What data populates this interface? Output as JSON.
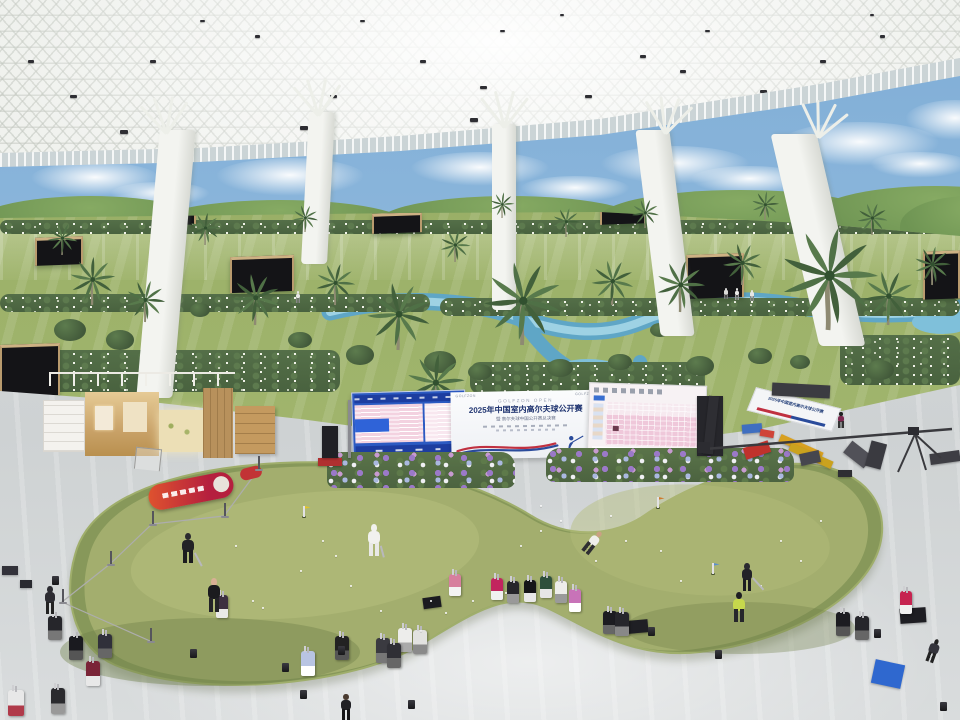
{
  "banner": {
    "top_label": "GOLFZON OPEN",
    "title": "2025年中国室内高尔夫球公开赛",
    "subtitle": "暨 高尔夫球中国公开赛总决赛",
    "left_logo": "GOLFZON",
    "right_logo": "GOLFZON"
  },
  "colors": {
    "ceiling": "#f4f5f2",
    "sky_mural": "#8fb9dd",
    "turf": "#9db26a",
    "floor": "#d3d7d8",
    "putting_green": "#8a9b5c",
    "putting_green_light": "#a2ad6d",
    "water": "#6fb3cf",
    "banner_navy": "#1f3470",
    "wave_red": "#c03040",
    "wave_blue": "#2a4b9b",
    "led_blue": "#2c5ac2",
    "led_pink": "#efc8da",
    "flower_purple": "#9b79c8",
    "flower_blue": "#aab8e0",
    "flower_white": "#f0f0f4",
    "booth_wood": "#c9a268",
    "red_bag": "#b51f3e"
  },
  "ceiling_lamps": [
    [
      70,
      95
    ],
    [
      150,
      60
    ],
    [
      255,
      35
    ],
    [
      330,
      95
    ],
    [
      420,
      60
    ],
    [
      500,
      30
    ],
    [
      585,
      95
    ],
    [
      640,
      55
    ],
    [
      705,
      30
    ],
    [
      760,
      90
    ],
    [
      820,
      60
    ],
    [
      880,
      35
    ],
    [
      915,
      88
    ],
    [
      120,
      130
    ],
    [
      300,
      126
    ],
    [
      470,
      118
    ],
    [
      640,
      118
    ],
    [
      790,
      108
    ],
    [
      900,
      100
    ],
    [
      200,
      20
    ],
    [
      560,
      14
    ],
    [
      680,
      70
    ],
    [
      28,
      60
    ],
    [
      480,
      86
    ],
    [
      725,
      112
    ],
    [
      870,
      14
    ],
    [
      360,
      20
    ]
  ],
  "clouds": [
    [
      30,
      162,
      130,
      34
    ],
    [
      215,
      158,
      150,
      38
    ],
    [
      410,
      152,
      140,
      34
    ],
    [
      600,
      146,
      150,
      38
    ],
    [
      780,
      122,
      160,
      44
    ],
    [
      905,
      100,
      100,
      40
    ],
    [
      110,
      182,
      100,
      24
    ],
    [
      520,
      176,
      110,
      26
    ],
    [
      690,
      166,
      120,
      28
    ],
    [
      870,
      152,
      100,
      26
    ]
  ],
  "hills": [
    [
      -30,
      196,
      240,
      60
    ],
    [
      150,
      200,
      260,
      52
    ],
    [
      380,
      196,
      260,
      50
    ],
    [
      600,
      190,
      280,
      56
    ],
    [
      810,
      186,
      250,
      66
    ],
    [
      900,
      196,
      140,
      60
    ]
  ],
  "columns": [
    {
      "x": 148,
      "y": 130,
      "w": 36,
      "h": 268,
      "skew": -5
    },
    {
      "x": 305,
      "y": 112,
      "w": 26,
      "h": 152,
      "skew": -3
    },
    {
      "x": 492,
      "y": 124,
      "w": 24,
      "h": 186,
      "skew": 0
    },
    {
      "x": 648,
      "y": 130,
      "w": 34,
      "h": 206,
      "skew": 7
    },
    {
      "x": 795,
      "y": 134,
      "w": 46,
      "h": 212,
      "skew": 13
    }
  ],
  "palms": [
    [
      92,
      305,
      0.75
    ],
    [
      145,
      322,
      0.65
    ],
    [
      255,
      325,
      0.8
    ],
    [
      335,
      305,
      0.65
    ],
    [
      398,
      350,
      1.05
    ],
    [
      455,
      262,
      0.5
    ],
    [
      522,
      345,
      1.3
    ],
    [
      566,
      237,
      0.45
    ],
    [
      612,
      305,
      0.7
    ],
    [
      680,
      312,
      0.8
    ],
    [
      742,
      285,
      0.65
    ],
    [
      828,
      330,
      1.6
    ],
    [
      888,
      325,
      0.85
    ],
    [
      932,
      285,
      0.6
    ],
    [
      62,
      255,
      0.5
    ],
    [
      205,
      245,
      0.5
    ],
    [
      305,
      232,
      0.42
    ],
    [
      502,
      218,
      0.4
    ],
    [
      645,
      228,
      0.45
    ],
    [
      765,
      220,
      0.45
    ],
    [
      872,
      235,
      0.5
    ],
    [
      435,
      415,
      0.95
    ],
    [
      572,
      432,
      0.7
    ]
  ],
  "pavilions": [
    [
      35,
      237,
      48,
      28
    ],
    [
      160,
      205,
      36,
      20
    ],
    [
      230,
      256,
      64,
      36
    ],
    [
      372,
      213,
      50,
      20
    ],
    [
      600,
      202,
      46,
      22
    ],
    [
      686,
      254,
      58,
      44
    ],
    [
      923,
      251,
      37,
      48
    ],
    [
      0,
      344,
      60,
      52
    ],
    [
      806,
      208,
      38,
      18
    ]
  ],
  "hedges": [
    [
      0,
      220,
      960,
      14
    ],
    [
      0,
      294,
      430,
      18
    ],
    [
      440,
      298,
      520,
      18
    ],
    [
      0,
      350,
      340,
      42
    ],
    [
      840,
      335,
      120,
      50
    ],
    [
      470,
      362,
      235,
      32
    ]
  ],
  "bushes": [
    [
      70,
      330,
      16
    ],
    [
      120,
      340,
      14
    ],
    [
      300,
      340,
      12
    ],
    [
      360,
      355,
      14
    ],
    [
      440,
      362,
      16
    ],
    [
      480,
      372,
      12
    ],
    [
      560,
      368,
      13
    ],
    [
      620,
      362,
      12
    ],
    [
      700,
      366,
      14
    ],
    [
      760,
      356,
      12
    ],
    [
      800,
      362,
      10
    ],
    [
      880,
      370,
      14
    ],
    [
      200,
      310,
      10
    ],
    [
      660,
      330,
      10
    ]
  ],
  "flower_beds": [
    [
      327,
      452,
      188,
      36
    ],
    [
      546,
      448,
      248,
      34
    ]
  ],
  "people": [
    [
      188,
      563,
      30,
      "#222226",
      "#1c1c1f",
      "#2a2a2e",
      0
    ],
    [
      214,
      612,
      34,
      "#1b1b1e",
      "#232327",
      "#d8b094",
      0
    ],
    [
      374,
      556,
      32,
      "#f1f1ee",
      "#e9e9e6",
      "#f1f1ee",
      0
    ],
    [
      586,
      553,
      26,
      "#efefeb",
      "#2e2e32",
      "#caa183",
      38
    ],
    [
      747,
      591,
      28,
      "#222228",
      "#1d1d22",
      "#2a2a30",
      0
    ],
    [
      739,
      622,
      30,
      "#c6d84c",
      "#26262b",
      "#1d1d22",
      0
    ],
    [
      50,
      614,
      28,
      "#2c2c32",
      "#222222",
      "#2c2c32",
      0
    ],
    [
      346,
      720,
      26,
      "#202024",
      "#151517",
      "#4a3b30",
      0
    ],
    [
      930,
      662,
      24,
      "#34343c",
      "#222222",
      "#222222",
      20
    ],
    [
      841,
      428,
      16,
      "#7e2950",
      "#333333",
      "#222222",
      0
    ],
    [
      298,
      303,
      12,
      "#e8e8e6",
      "#888888",
      "#e8e8e6",
      0
    ],
    [
      737,
      300,
      12,
      "#eaeae8",
      "#999999",
      "#eaeae8",
      0
    ],
    [
      752,
      301,
      11,
      "#e6e6e4",
      "#888888",
      "#e6e6e4",
      0
    ],
    [
      726,
      299,
      11,
      "#dadad8",
      "#777777",
      "#dadad8",
      0
    ]
  ],
  "putters": [
    [
      195,
      552,
      15,
      62
    ],
    [
      753,
      577,
      16,
      48
    ],
    [
      381,
      545,
      12,
      75
    ]
  ],
  "golf_bags": [
    [
      455,
      596,
      "#d77f9e",
      "#f3f3f3"
    ],
    [
      497,
      600,
      "#c2245e",
      "#f0f0f0"
    ],
    [
      513,
      603,
      "#26262b",
      "#999999"
    ],
    [
      530,
      602,
      "#151518",
      "#e8e8e8"
    ],
    [
      546,
      598,
      "#2e4f3c",
      "#e6e6e6"
    ],
    [
      561,
      603,
      "#ededea",
      "#9a9a9a"
    ],
    [
      575,
      612,
      "#c873b8",
      "#ffffff"
    ],
    [
      610,
      634,
      "#1c1c21",
      "#666666"
    ],
    [
      622,
      636,
      "#26262b",
      "#888888"
    ],
    [
      405,
      652,
      "#ededeb",
      "#aaaaaa"
    ],
    [
      420,
      654,
      "#e2e2e0",
      "#8a8a8a"
    ],
    [
      383,
      663,
      "#3a3a40",
      "#777777"
    ],
    [
      394,
      668,
      "#2f2f35",
      "#666666"
    ],
    [
      308,
      676,
      "#b8c4e2",
      "#ffffff"
    ],
    [
      342,
      660,
      "#222222",
      "#555555"
    ],
    [
      55,
      640,
      "#26262b",
      "#777777"
    ],
    [
      76,
      660,
      "#1a1a1f",
      "#555555"
    ],
    [
      93,
      686,
      "#7a2437",
      "#e8e8e8"
    ],
    [
      58,
      714,
      "#2a2a2e",
      "#999999"
    ],
    [
      16,
      716,
      "#e8e8e8",
      "#b03a4a"
    ],
    [
      105,
      658,
      "#30303a",
      "#666666"
    ],
    [
      222,
      618,
      "#3c3040",
      "#e9e9e7"
    ],
    [
      843,
      636,
      "#1c1c21",
      "#555555"
    ],
    [
      862,
      640,
      "#26262b",
      "#666666"
    ],
    [
      906,
      614,
      "#c62450",
      "#f0f0f0"
    ]
  ],
  "balls": [
    [
      322,
      540
    ],
    [
      335,
      555
    ],
    [
      350,
      585
    ],
    [
      380,
      610
    ],
    [
      430,
      600
    ],
    [
      445,
      612
    ],
    [
      520,
      545
    ],
    [
      540,
      530
    ],
    [
      560,
      520
    ],
    [
      610,
      515
    ],
    [
      625,
      540
    ],
    [
      660,
      550
    ],
    [
      680,
      580
    ],
    [
      540,
      505
    ],
    [
      595,
      560
    ],
    [
      420,
      630
    ],
    [
      300,
      570
    ],
    [
      252,
      600
    ],
    [
      262,
      607
    ],
    [
      780,
      540
    ],
    [
      800,
      560
    ],
    [
      760,
      585
    ],
    [
      820,
      520
    ],
    [
      235,
      545
    ],
    [
      505,
      592
    ],
    [
      472,
      600
    ]
  ],
  "flags": [
    [
      303,
      506,
      "#e4c428"
    ],
    [
      657,
      497,
      "#cf7a2c"
    ],
    [
      712,
      563,
      "#5a8fd0"
    ]
  ],
  "stanchions": [
    [
      258,
      468
    ],
    [
      224,
      515
    ],
    [
      152,
      523
    ],
    [
      110,
      563
    ],
    [
      62,
      601
    ],
    [
      150,
      640
    ]
  ],
  "uplights": [
    [
      282,
      663
    ],
    [
      338,
      646
    ],
    [
      715,
      650
    ],
    [
      648,
      627
    ],
    [
      190,
      649
    ],
    [
      874,
      629
    ],
    [
      52,
      576
    ],
    [
      940,
      702
    ],
    [
      300,
      690
    ],
    [
      408,
      700
    ]
  ],
  "equipment_boxes": [
    [
      697,
      396,
      26,
      60,
      "#26262b",
      0
    ],
    [
      772,
      384,
      58,
      13,
      "#3b3b41",
      3
    ],
    [
      742,
      424,
      20,
      9,
      "#3f6fc0",
      -5
    ],
    [
      744,
      444,
      26,
      12,
      "#c0322c",
      -18
    ],
    [
      760,
      430,
      14,
      7,
      "#cf4438",
      10
    ],
    [
      778,
      443,
      46,
      8,
      "#d8a020",
      24
    ],
    [
      788,
      452,
      46,
      8,
      "#caa21e",
      24
    ],
    [
      800,
      452,
      20,
      12,
      "#46464e",
      -12
    ],
    [
      845,
      447,
      26,
      15,
      "#515158",
      38
    ],
    [
      868,
      442,
      16,
      26,
      "#3a3a40",
      15
    ],
    [
      930,
      452,
      30,
      11,
      "#3e3e44",
      -8
    ],
    [
      838,
      470,
      14,
      7,
      "#2e2e33",
      0
    ],
    [
      628,
      620,
      20,
      13,
      "#1f1f24",
      -5
    ],
    [
      423,
      597,
      18,
      11,
      "#1b1b20",
      -8
    ],
    [
      900,
      608,
      26,
      15,
      "#1e1e23",
      -4
    ],
    [
      2,
      566,
      16,
      9,
      "#32323a",
      0
    ],
    [
      20,
      580,
      12,
      8,
      "#2a2a30",
      0
    ],
    [
      873,
      662,
      30,
      24,
      "#2f68cf",
      12
    ],
    [
      706,
      396,
      10,
      58,
      "#2e2e33",
      6
    ],
    [
      348,
      400,
      3,
      58,
      "#8a8a90",
      0
    ],
    [
      318,
      458,
      24,
      8,
      "#b03030",
      0
    ],
    [
      322,
      426,
      16,
      32,
      "#202025",
      0
    ]
  ]
}
